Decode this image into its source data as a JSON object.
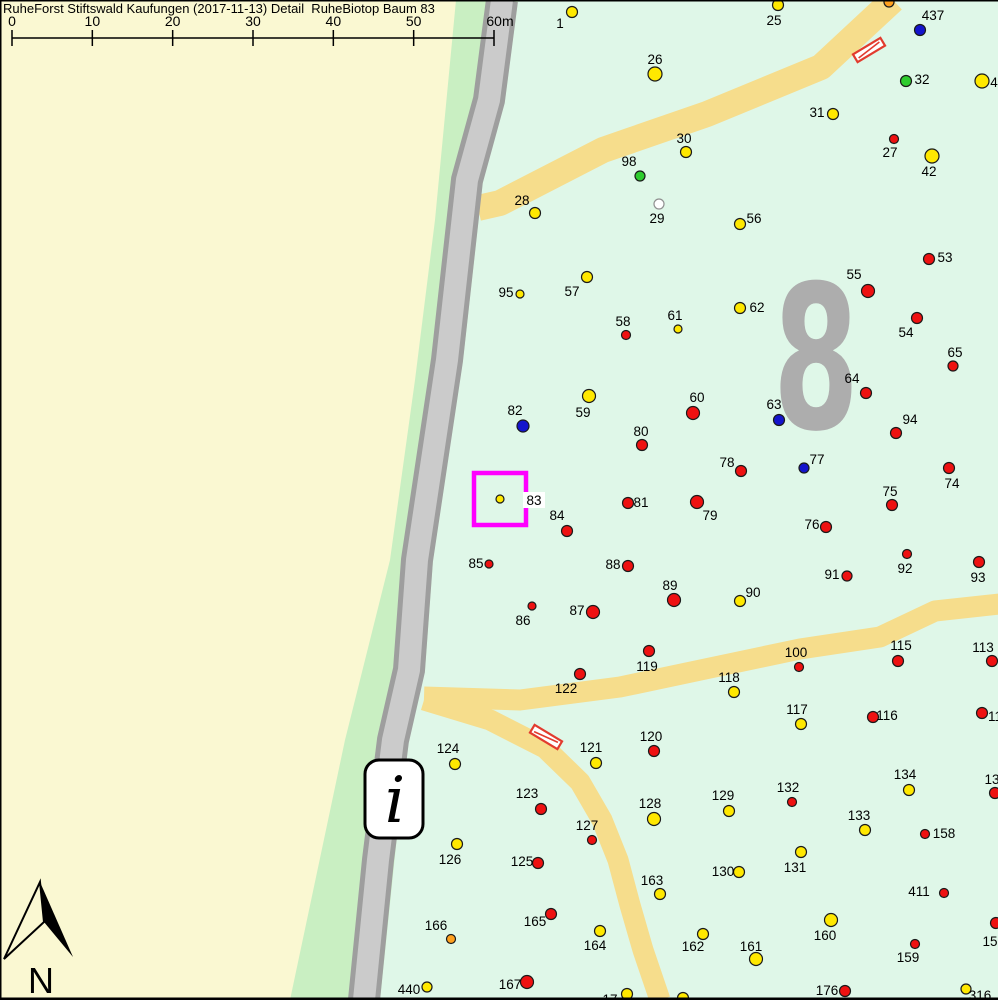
{
  "title": "RuheForst Stiftswald Kaufungen (2017-11-13) Detail  RuheBiotop Baum 83",
  "scale_bar": {
    "labels": [
      "0",
      "10",
      "20",
      "30",
      "40",
      "50",
      "60m"
    ],
    "x_start": 12,
    "x_end": 494
  },
  "north": {
    "label": "N"
  },
  "info_marker": {
    "label": "i"
  },
  "compartment": {
    "label": "8"
  },
  "highlight_box": {
    "tree": "83",
    "color": "#FF00FF"
  },
  "colors": {
    "yellow": "#FFE800",
    "red": "#EE1111",
    "blue": "#1414CC",
    "green": "#2ECC2E",
    "white": "#FFFFFF",
    "orange": "#FFA01E",
    "cream": "#FAF8D2",
    "strip": "#C9EFC2",
    "mint": "#DFF7E8",
    "path": "#F6DD8C",
    "road_fill": "#CBCBCB",
    "road_edge": "#9E9E9E",
    "gray8": "#ADADAD",
    "hatch": "#E23B2E",
    "highlight": "#FF00FF"
  },
  "hatch_bars": [
    {
      "x": 869,
      "y": 50,
      "angle": -31
    },
    {
      "x": 546,
      "y": 737,
      "angle": 31
    }
  ],
  "trees": [
    {
      "n": "1",
      "x": 572,
      "y": 12,
      "c": "yellow",
      "r": 5.5,
      "lx": 560,
      "ly": 23
    },
    {
      "n": "25",
      "x": 778,
      "y": 5,
      "c": "yellow",
      "r": 5.5,
      "lx": 774,
      "ly": 20
    },
    {
      "n": "",
      "x": 889,
      "y": 2,
      "c": "orange",
      "r": 5,
      "lx": 0,
      "ly": 0
    },
    {
      "n": "437",
      "x": 920,
      "y": 30,
      "c": "blue",
      "r": 5.5,
      "lx": 933,
      "ly": 15
    },
    {
      "n": "26",
      "x": 655,
      "y": 74,
      "c": "yellow",
      "r": 7,
      "lx": 655,
      "ly": 59
    },
    {
      "n": "32",
      "x": 906,
      "y": 81,
      "c": "green",
      "r": 5.5,
      "lx": 922,
      "ly": 79
    },
    {
      "n": "4",
      "x": 982,
      "y": 81,
      "c": "yellow",
      "r": 7,
      "lx": 994,
      "ly": 82
    },
    {
      "n": "31",
      "x": 833,
      "y": 114,
      "c": "yellow",
      "r": 5.5,
      "lx": 817,
      "ly": 112
    },
    {
      "n": "27",
      "x": 894,
      "y": 139,
      "c": "red",
      "r": 4.5,
      "lx": 890,
      "ly": 152
    },
    {
      "n": "30",
      "x": 686,
      "y": 152,
      "c": "yellow",
      "r": 5.5,
      "lx": 684,
      "ly": 138
    },
    {
      "n": "42",
      "x": 932,
      "y": 156,
      "c": "yellow",
      "r": 7,
      "lx": 929,
      "ly": 171
    },
    {
      "n": "98",
      "x": 640,
      "y": 176,
      "c": "green",
      "r": 5,
      "lx": 629,
      "ly": 161
    },
    {
      "n": "28",
      "x": 535,
      "y": 213,
      "c": "yellow",
      "r": 5.5,
      "lx": 522,
      "ly": 200
    },
    {
      "n": "29",
      "x": 659,
      "y": 204,
      "c": "white",
      "r": 5,
      "lx": 657,
      "ly": 218
    },
    {
      "n": "56",
      "x": 740,
      "y": 224,
      "c": "yellow",
      "r": 5.5,
      "lx": 754,
      "ly": 218
    },
    {
      "n": "53",
      "x": 929,
      "y": 259,
      "c": "red",
      "r": 5.5,
      "lx": 945,
      "ly": 257
    },
    {
      "n": "57",
      "x": 587,
      "y": 277,
      "c": "yellow",
      "r": 5.5,
      "lx": 572,
      "ly": 291
    },
    {
      "n": "95",
      "x": 520,
      "y": 294,
      "c": "yellow",
      "r": 4,
      "lx": 506,
      "ly": 292
    },
    {
      "n": "55",
      "x": 868,
      "y": 291,
      "c": "red",
      "r": 6.5,
      "lx": 854,
      "ly": 274
    },
    {
      "n": "62",
      "x": 740,
      "y": 308,
      "c": "yellow",
      "r": 5.5,
      "lx": 757,
      "ly": 307
    },
    {
      "n": "61",
      "x": 678,
      "y": 329,
      "c": "yellow",
      "r": 4,
      "lx": 675,
      "ly": 315
    },
    {
      "n": "58",
      "x": 626,
      "y": 335,
      "c": "red",
      "r": 4.5,
      "lx": 623,
      "ly": 321
    },
    {
      "n": "54",
      "x": 917,
      "y": 318,
      "c": "red",
      "r": 5.5,
      "lx": 906,
      "ly": 332
    },
    {
      "n": "65",
      "x": 953,
      "y": 366,
      "c": "red",
      "r": 5,
      "lx": 955,
      "ly": 352
    },
    {
      "n": "59",
      "x": 589,
      "y": 396,
      "c": "yellow",
      "r": 6.5,
      "lx": 583,
      "ly": 412
    },
    {
      "n": "60",
      "x": 693,
      "y": 413,
      "c": "red",
      "r": 6.5,
      "lx": 697,
      "ly": 397
    },
    {
      "n": "82",
      "x": 523,
      "y": 426,
      "c": "blue",
      "r": 6,
      "lx": 515,
      "ly": 410
    },
    {
      "n": "63",
      "x": 779,
      "y": 420,
      "c": "blue",
      "r": 5.5,
      "lx": 774,
      "ly": 404
    },
    {
      "n": "64",
      "x": 866,
      "y": 393,
      "c": "red",
      "r": 5.5,
      "lx": 852,
      "ly": 378
    },
    {
      "n": "94",
      "x": 896,
      "y": 433,
      "c": "red",
      "r": 5.5,
      "lx": 910,
      "ly": 419
    },
    {
      "n": "80",
      "x": 642,
      "y": 445,
      "c": "red",
      "r": 5.5,
      "lx": 641,
      "ly": 431
    },
    {
      "n": "77",
      "x": 804,
      "y": 468,
      "c": "blue",
      "r": 5,
      "lx": 817,
      "ly": 459
    },
    {
      "n": "78",
      "x": 741,
      "y": 471,
      "c": "red",
      "r": 5.5,
      "lx": 727,
      "ly": 462
    },
    {
      "n": "74",
      "x": 949,
      "y": 468,
      "c": "red",
      "r": 5.5,
      "lx": 952,
      "ly": 483
    },
    {
      "n": "83",
      "x": 500,
      "y": 499,
      "c": "yellow",
      "r": 4,
      "lx": 534,
      "ly": 500,
      "bg": true
    },
    {
      "n": "75",
      "x": 892,
      "y": 505,
      "c": "red",
      "r": 5.5,
      "lx": 890,
      "ly": 491
    },
    {
      "n": "81",
      "x": 628,
      "y": 503,
      "c": "red",
      "r": 5.5,
      "lx": 641,
      "ly": 502
    },
    {
      "n": "79",
      "x": 697,
      "y": 502,
      "c": "red",
      "r": 6.5,
      "lx": 710,
      "ly": 515
    },
    {
      "n": "84",
      "x": 567,
      "y": 531,
      "c": "red",
      "r": 5.5,
      "lx": 557,
      "ly": 515
    },
    {
      "n": "76",
      "x": 826,
      "y": 527,
      "c": "red",
      "r": 5.5,
      "lx": 812,
      "ly": 524
    },
    {
      "n": "85",
      "x": 489,
      "y": 564,
      "c": "red",
      "r": 4,
      "lx": 476,
      "ly": 563
    },
    {
      "n": "88",
      "x": 628,
      "y": 566,
      "c": "red",
      "r": 5.5,
      "lx": 613,
      "ly": 564
    },
    {
      "n": "92",
      "x": 907,
      "y": 554,
      "c": "red",
      "r": 4.5,
      "lx": 905,
      "ly": 568
    },
    {
      "n": "93",
      "x": 979,
      "y": 562,
      "c": "red",
      "r": 5.5,
      "lx": 978,
      "ly": 577
    },
    {
      "n": "91",
      "x": 847,
      "y": 576,
      "c": "red",
      "r": 5,
      "lx": 832,
      "ly": 574
    },
    {
      "n": "89",
      "x": 674,
      "y": 600,
      "c": "red",
      "r": 6.5,
      "lx": 670,
      "ly": 585
    },
    {
      "n": "90",
      "x": 740,
      "y": 601,
      "c": "yellow",
      "r": 5.5,
      "lx": 753,
      "ly": 592
    },
    {
      "n": "86",
      "x": 532,
      "y": 606,
      "c": "red",
      "r": 4,
      "lx": 523,
      "ly": 620
    },
    {
      "n": "87",
      "x": 593,
      "y": 612,
      "c": "red",
      "r": 6.5,
      "lx": 577,
      "ly": 610
    },
    {
      "n": "119",
      "x": 649,
      "y": 651,
      "c": "red",
      "r": 5.5,
      "lx": 647,
      "ly": 666
    },
    {
      "n": "100",
      "x": 799,
      "y": 667,
      "c": "red",
      "r": 4.5,
      "lx": 796,
      "ly": 652
    },
    {
      "n": "115",
      "x": 898,
      "y": 661,
      "c": "red",
      "r": 5.5,
      "lx": 901,
      "ly": 645
    },
    {
      "n": "113",
      "x": 992,
      "y": 661,
      "c": "red",
      "r": 5.5,
      "lx": 983,
      "ly": 647
    },
    {
      "n": "122",
      "x": 580,
      "y": 674,
      "c": "red",
      "r": 5.5,
      "lx": 566,
      "ly": 688
    },
    {
      "n": "118",
      "x": 734,
      "y": 692,
      "c": "yellow",
      "r": 5.5,
      "lx": 729,
      "ly": 677
    },
    {
      "n": "117",
      "x": 801,
      "y": 724,
      "c": "yellow",
      "r": 5.5,
      "lx": 797,
      "ly": 709
    },
    {
      "n": "116",
      "x": 873,
      "y": 717,
      "c": "red",
      "r": 5.5,
      "lx": 887,
      "ly": 715
    },
    {
      "n": "11",
      "x": 982,
      "y": 713,
      "c": "red",
      "r": 5.5,
      "lx": 995,
      "ly": 716
    },
    {
      "n": "124",
      "x": 455,
      "y": 764,
      "c": "yellow",
      "r": 5.5,
      "lx": 448,
      "ly": 748
    },
    {
      "n": "121",
      "x": 596,
      "y": 763,
      "c": "yellow",
      "r": 5.5,
      "lx": 591,
      "ly": 747
    },
    {
      "n": "120",
      "x": 654,
      "y": 751,
      "c": "red",
      "r": 5.5,
      "lx": 651,
      "ly": 736
    },
    {
      "n": "134",
      "x": 909,
      "y": 790,
      "c": "yellow",
      "r": 5.5,
      "lx": 905,
      "ly": 774
    },
    {
      "n": "13",
      "x": 995,
      "y": 793,
      "c": "red",
      "r": 5.5,
      "lx": 992,
      "ly": 779
    },
    {
      "n": "123",
      "x": 541,
      "y": 809,
      "c": "red",
      "r": 5.5,
      "lx": 527,
      "ly": 793
    },
    {
      "n": "132",
      "x": 792,
      "y": 802,
      "c": "red",
      "r": 4.5,
      "lx": 788,
      "ly": 787
    },
    {
      "n": "129",
      "x": 729,
      "y": 811,
      "c": "yellow",
      "r": 5.5,
      "lx": 723,
      "ly": 795
    },
    {
      "n": "128",
      "x": 654,
      "y": 819,
      "c": "yellow",
      "r": 6.5,
      "lx": 650,
      "ly": 803
    },
    {
      "n": "133",
      "x": 865,
      "y": 830,
      "c": "yellow",
      "r": 5.5,
      "lx": 859,
      "ly": 815
    },
    {
      "n": "158",
      "x": 925,
      "y": 834,
      "c": "red",
      "r": 4.5,
      "lx": 944,
      "ly": 833
    },
    {
      "n": "127",
      "x": 592,
      "y": 840,
      "c": "red",
      "r": 4.5,
      "lx": 587,
      "ly": 825
    },
    {
      "n": "126",
      "x": 457,
      "y": 844,
      "c": "yellow",
      "r": 5.5,
      "lx": 450,
      "ly": 859
    },
    {
      "n": "125",
      "x": 538,
      "y": 863,
      "c": "red",
      "r": 5.5,
      "lx": 522,
      "ly": 861
    },
    {
      "n": "131",
      "x": 801,
      "y": 852,
      "c": "yellow",
      "r": 5.5,
      "lx": 795,
      "ly": 867
    },
    {
      "n": "130",
      "x": 739,
      "y": 872,
      "c": "yellow",
      "r": 5.5,
      "lx": 723,
      "ly": 871
    },
    {
      "n": "163",
      "x": 660,
      "y": 894,
      "c": "yellow",
      "r": 5.5,
      "lx": 652,
      "ly": 880
    },
    {
      "n": "411",
      "x": 944,
      "y": 893,
      "c": "red",
      "r": 4.5,
      "lx": 919,
      "ly": 891
    },
    {
      "n": "165",
      "x": 551,
      "y": 914,
      "c": "red",
      "r": 5.5,
      "lx": 535,
      "ly": 921
    },
    {
      "n": "160",
      "x": 831,
      "y": 920,
      "c": "yellow",
      "r": 6.5,
      "lx": 825,
      "ly": 935
    },
    {
      "n": "164",
      "x": 600,
      "y": 931,
      "c": "yellow",
      "r": 5.5,
      "lx": 595,
      "ly": 945
    },
    {
      "n": "162",
      "x": 703,
      "y": 934,
      "c": "yellow",
      "r": 5.5,
      "lx": 693,
      "ly": 946
    },
    {
      "n": "15",
      "x": 996,
      "y": 923,
      "c": "red",
      "r": 5.5,
      "lx": 990,
      "ly": 941
    },
    {
      "n": "159",
      "x": 915,
      "y": 944,
      "c": "red",
      "r": 4.5,
      "lx": 908,
      "ly": 957
    },
    {
      "n": "161",
      "x": 756,
      "y": 959,
      "c": "yellow",
      "r": 6.5,
      "lx": 751,
      "ly": 946
    },
    {
      "n": "166",
      "x": 451,
      "y": 939,
      "c": "orange",
      "r": 4.5,
      "lx": 436,
      "ly": 925
    },
    {
      "n": "167",
      "x": 527,
      "y": 982,
      "c": "red",
      "r": 6.5,
      "lx": 510,
      "ly": 984
    },
    {
      "n": "440",
      "x": 427,
      "y": 987,
      "c": "yellow",
      "r": 5,
      "lx": 409,
      "ly": 989
    },
    {
      "n": "176",
      "x": 845,
      "y": 991,
      "c": "red",
      "r": 5.5,
      "lx": 827,
      "ly": 990
    },
    {
      "n": "316",
      "x": 966,
      "y": 989,
      "c": "yellow",
      "r": 5,
      "lx": 980,
      "ly": 995
    },
    {
      "n": "17",
      "x": 627,
      "y": 994,
      "c": "yellow",
      "r": 5.5,
      "lx": 610,
      "ly": 999
    },
    {
      "n": "",
      "x": 683,
      "y": 998,
      "c": "yellow",
      "r": 5.5,
      "lx": 0,
      "ly": 0
    }
  ]
}
